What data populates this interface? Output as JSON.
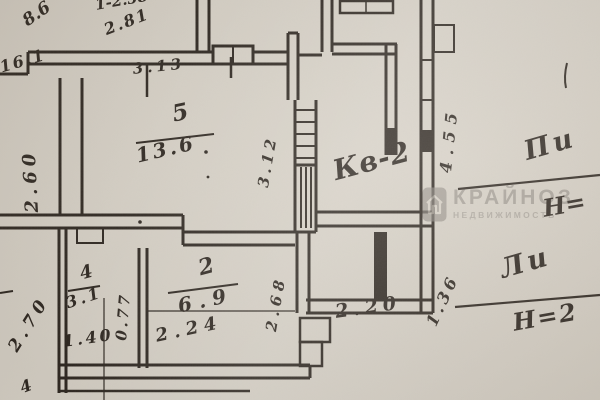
{
  "watermark": {
    "brand": "КРАЙНОЗ",
    "subtitle": "НЕДВИЖИМОСТЬ"
  },
  "apartment": {
    "label": "Кв-2"
  },
  "rooms": {
    "room5": {
      "number": "5",
      "area": "13.6"
    },
    "room2": {
      "number": "2",
      "area": "6.9"
    },
    "room4": {
      "number": "4",
      "area": "3.1"
    }
  },
  "dimensions": {
    "top_a": "8.6",
    "top_b": "16.1",
    "top_c": "1-2.58",
    "top_d": "2.81",
    "top_e": "3.13",
    "left_vert": "2.60",
    "mid_vert": "3.12",
    "right_vert": "4.55",
    "right_diag": "1.36",
    "bottom_left_diag": "2.70",
    "door_a": "0.77",
    "door_b": "1.40",
    "room2_width": "2.24",
    "bottom_right": "2.20",
    "hall_vert": "2.68",
    "corner_partial": "4",
    "top_edge_partial": "6"
  },
  "annotations": {
    "lit_top": {
      "label": "Пи",
      "height": "Н="
    },
    "lit_bottom": {
      "label": "Ли",
      "height": "Н=2"
    }
  }
}
